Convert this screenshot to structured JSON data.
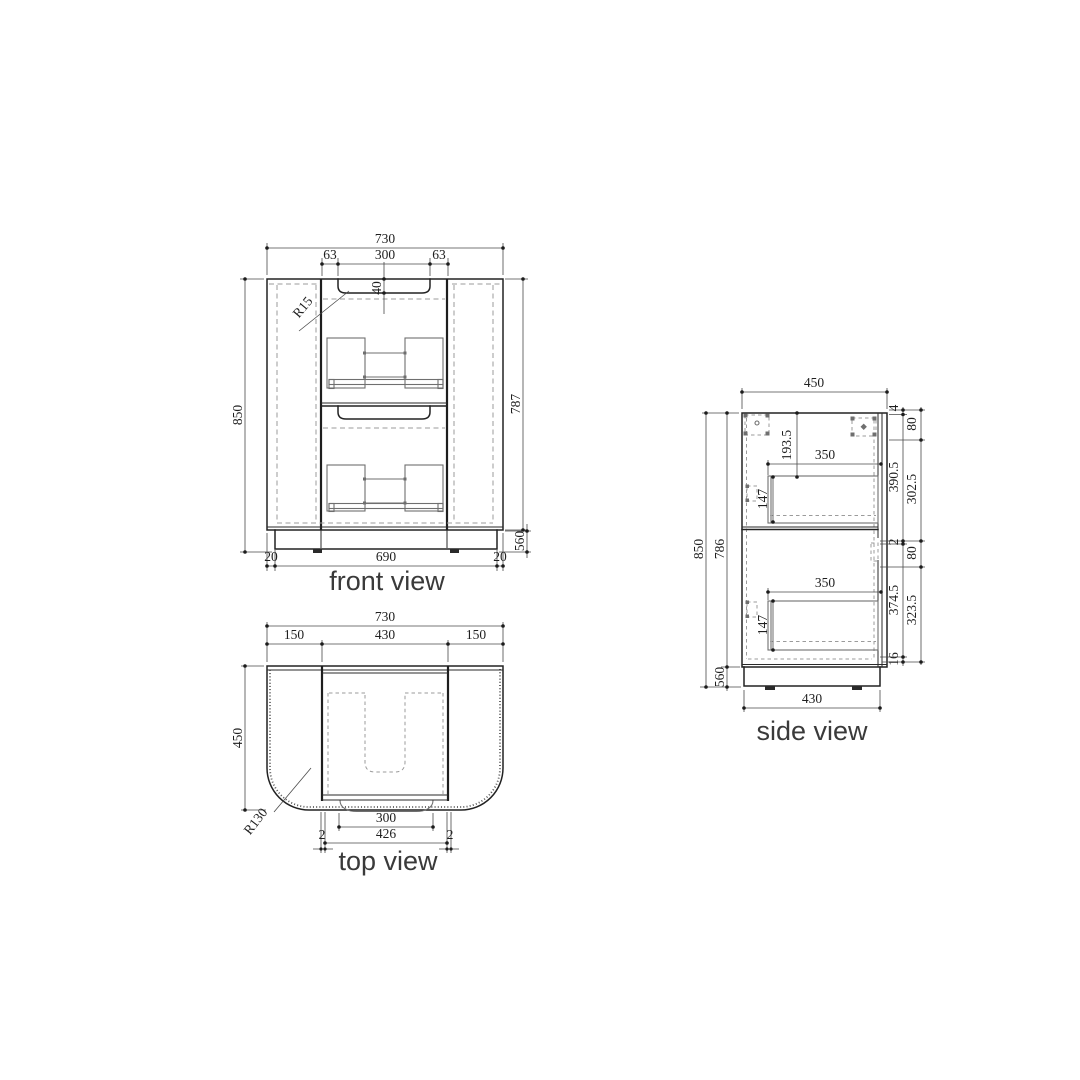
{
  "views": {
    "front": {
      "title": "front view",
      "dims": {
        "overall_width": "730",
        "groove_offset_left": "63",
        "groove_width": "300",
        "groove_offset_right": "63",
        "groove_depth": "40",
        "groove_radius": "R15",
        "overall_height": "850",
        "body_height": "787",
        "plinth_height": "560",
        "plinth_inset_left": "20",
        "plinth_width": "690",
        "plinth_inset_right": "20"
      }
    },
    "top": {
      "title": "top view",
      "dims": {
        "overall_width": "730",
        "side_panel_left": "150",
        "opening_width": "430",
        "side_panel_right": "150",
        "overall_depth": "450",
        "corner_radius": "R130",
        "groove_width": "300",
        "door_width": "426",
        "door_gap_left": "2",
        "door_gap_right": "2"
      }
    },
    "side": {
      "title": "side view",
      "dims": {
        "overall_depth": "450",
        "top_to_drawer": "193.5",
        "upper_drawer_depth": "350",
        "upper_drawer_height": "147",
        "overall_height": "850",
        "body_height": "786",
        "plinth_height": "560",
        "lower_drawer_depth": "350",
        "lower_drawer_height": "147",
        "base_depth": "430",
        "top_thickness": "4",
        "upper_section_height": "390.5",
        "mid_gap": "2",
        "lower_section_height": "374.5",
        "bottom_thickness": "16",
        "mount_top_offset": "80",
        "mount_upper_span": "302.5",
        "mount_mid_offset": "80",
        "mount_lower_span": "323.5"
      }
    }
  }
}
